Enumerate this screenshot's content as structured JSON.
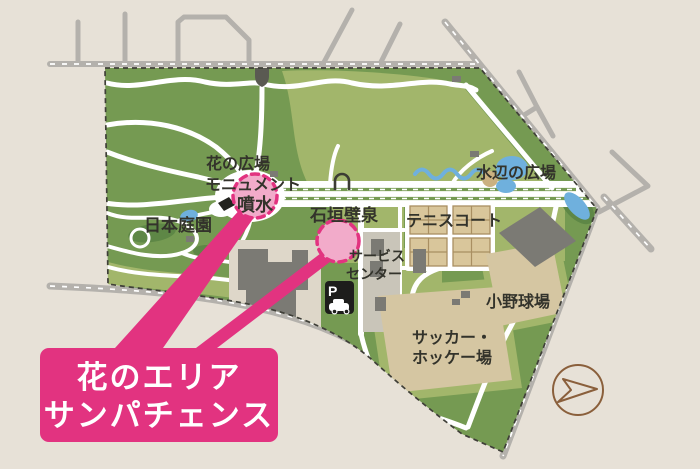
{
  "map": {
    "type": "illustrated-park-map",
    "colors": {
      "bg": "#e7e1d7",
      "road_gray": "#b4b1ac",
      "park_green": "#759a52",
      "light_green": "#a2b66b",
      "tree_green": "#5e8746",
      "water_blue": "#6fb0dd",
      "building_gray": "#7b7a74",
      "plot_cream": "#ded7c9",
      "service_gray": "#c9c5b9",
      "field_tan": "#d5c6a2",
      "court_tan": "#d9c69b",
      "court_line": "#a98f62",
      "boundary_dark": "#3f3f38",
      "label_dark": "#33332b",
      "accent_pink": "#e23380",
      "circle_pink": "#f2abca",
      "arrow_brown": "#8a5f3b",
      "icon_black": "#1d1d1b"
    },
    "areas": {
      "flower_plaza": "花の広場",
      "monument": "モニュメント",
      "fountain": "噴水",
      "japanese_garden": "日本庭園",
      "stone_wall_fountain": "石垣壁泉",
      "waterside_plaza": "水辺の広場",
      "tennis_court": "テニスコート",
      "service_center_line1": "サービス",
      "service_center_line2": "センター",
      "ono_baseball_field": "小野球場",
      "soccer_hockey_line1": "サッカー・",
      "soccer_hockey_line2": "ホッケー場"
    },
    "parking_label": "P",
    "callout": {
      "line1": "花のエリア",
      "line2": "サンパチェンス"
    },
    "icons": {
      "parking_icon": "white P with car pictogram on black square",
      "direction_arrow_icon": "brown outlined circle with right-pointing arrow",
      "gate_icon": "dark shield-shaped park gate",
      "arch_icon": "small arch/monument outline"
    }
  }
}
